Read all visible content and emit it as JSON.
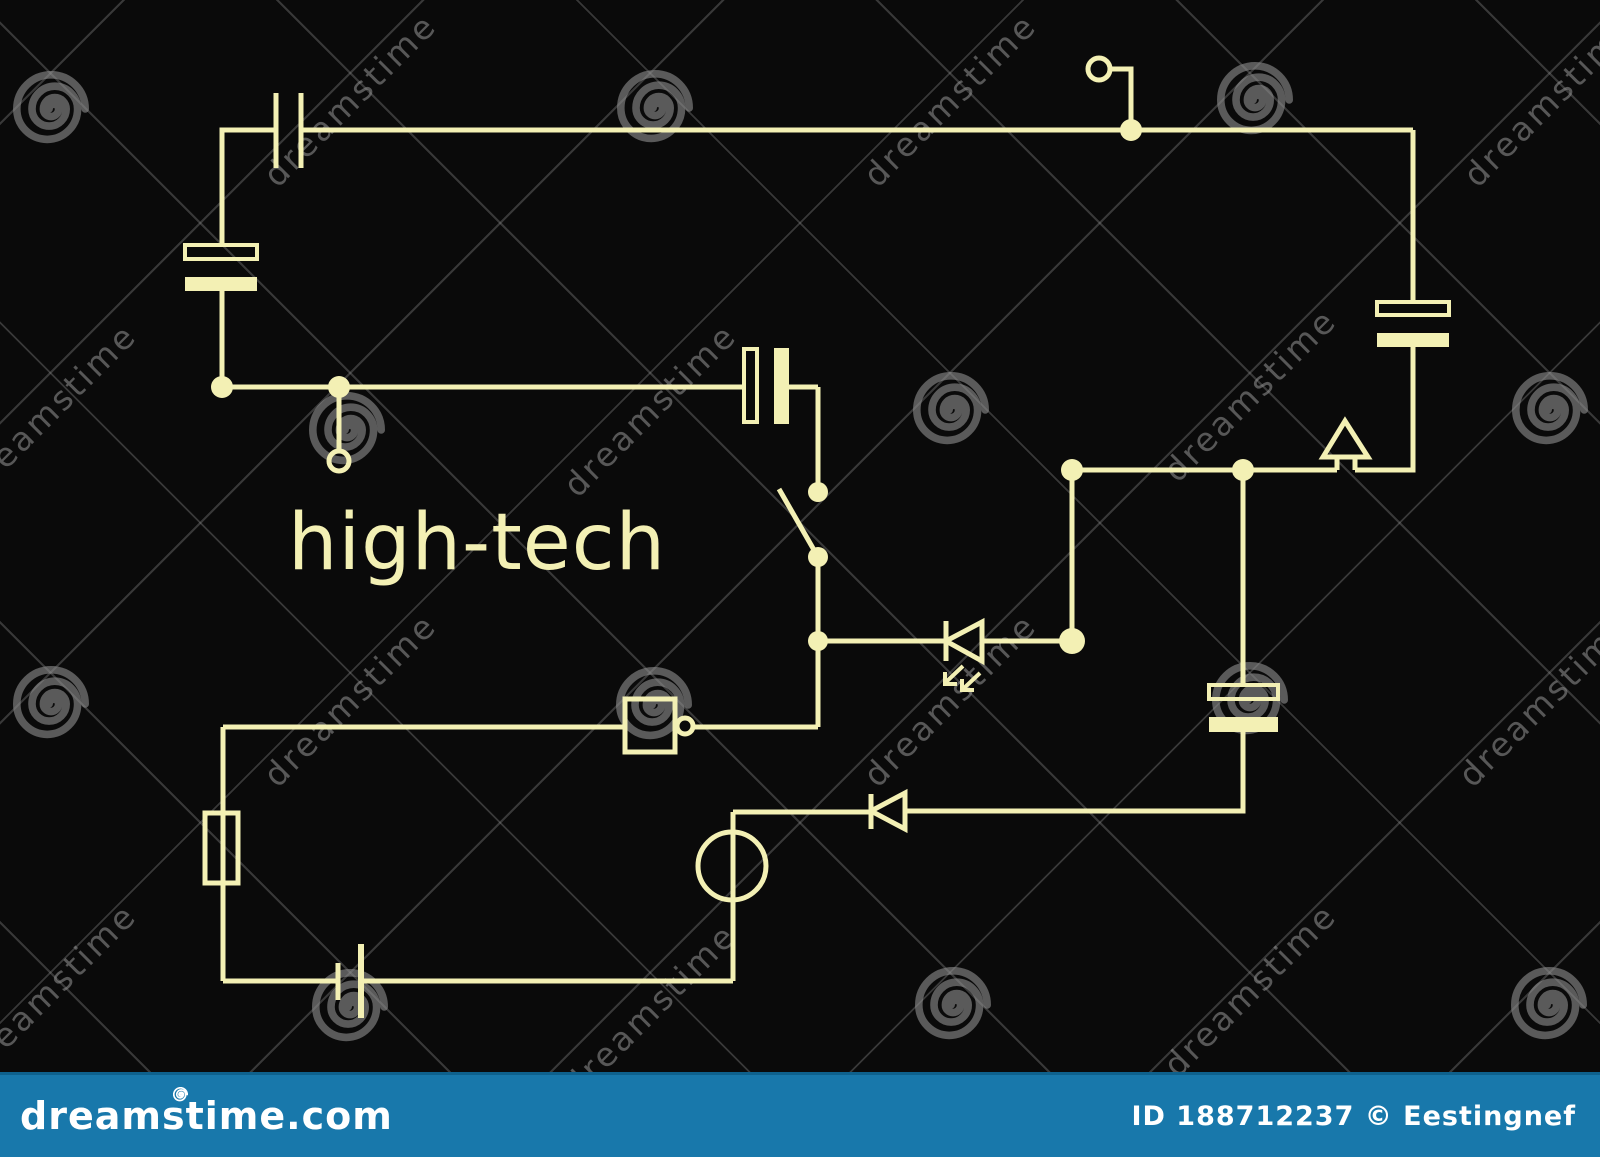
{
  "title": "high-tech",
  "watermark": {
    "label": "dreamstime"
  },
  "footer": {
    "site": "dreamstime.com",
    "credit": "ID 188712237 © Eestingnef"
  },
  "colors": {
    "background": "#0a0a0a",
    "wire": "#f3f0b4",
    "footer_bar": "#1878ab",
    "footer_text": "#ffffff",
    "watermark_gray": "#8f8f8f"
  },
  "components": [
    {
      "id": "capacitor-top-left",
      "type": "capacitor"
    },
    {
      "id": "polarized-capacitor-left",
      "type": "polarized-capacitor"
    },
    {
      "id": "open-terminal-left",
      "type": "terminal"
    },
    {
      "id": "polarized-capacitor-middle",
      "type": "polarized-capacitor"
    },
    {
      "id": "open-switch",
      "type": "switch"
    },
    {
      "id": "led",
      "type": "light-emitting-diode"
    },
    {
      "id": "open-terminal-top-right",
      "type": "terminal"
    },
    {
      "id": "polarized-capacitor-right",
      "type": "polarized-capacitor"
    },
    {
      "id": "antenna-arrow",
      "type": "antenna"
    },
    {
      "id": "polarized-capacitor-lower-right",
      "type": "polarized-capacitor"
    },
    {
      "id": "diode",
      "type": "diode"
    },
    {
      "id": "lamp-generator",
      "type": "lamp"
    },
    {
      "id": "inverter-gate",
      "type": "logic-gate"
    },
    {
      "id": "fuse",
      "type": "fuse"
    },
    {
      "id": "battery-cell",
      "type": "battery"
    }
  ]
}
